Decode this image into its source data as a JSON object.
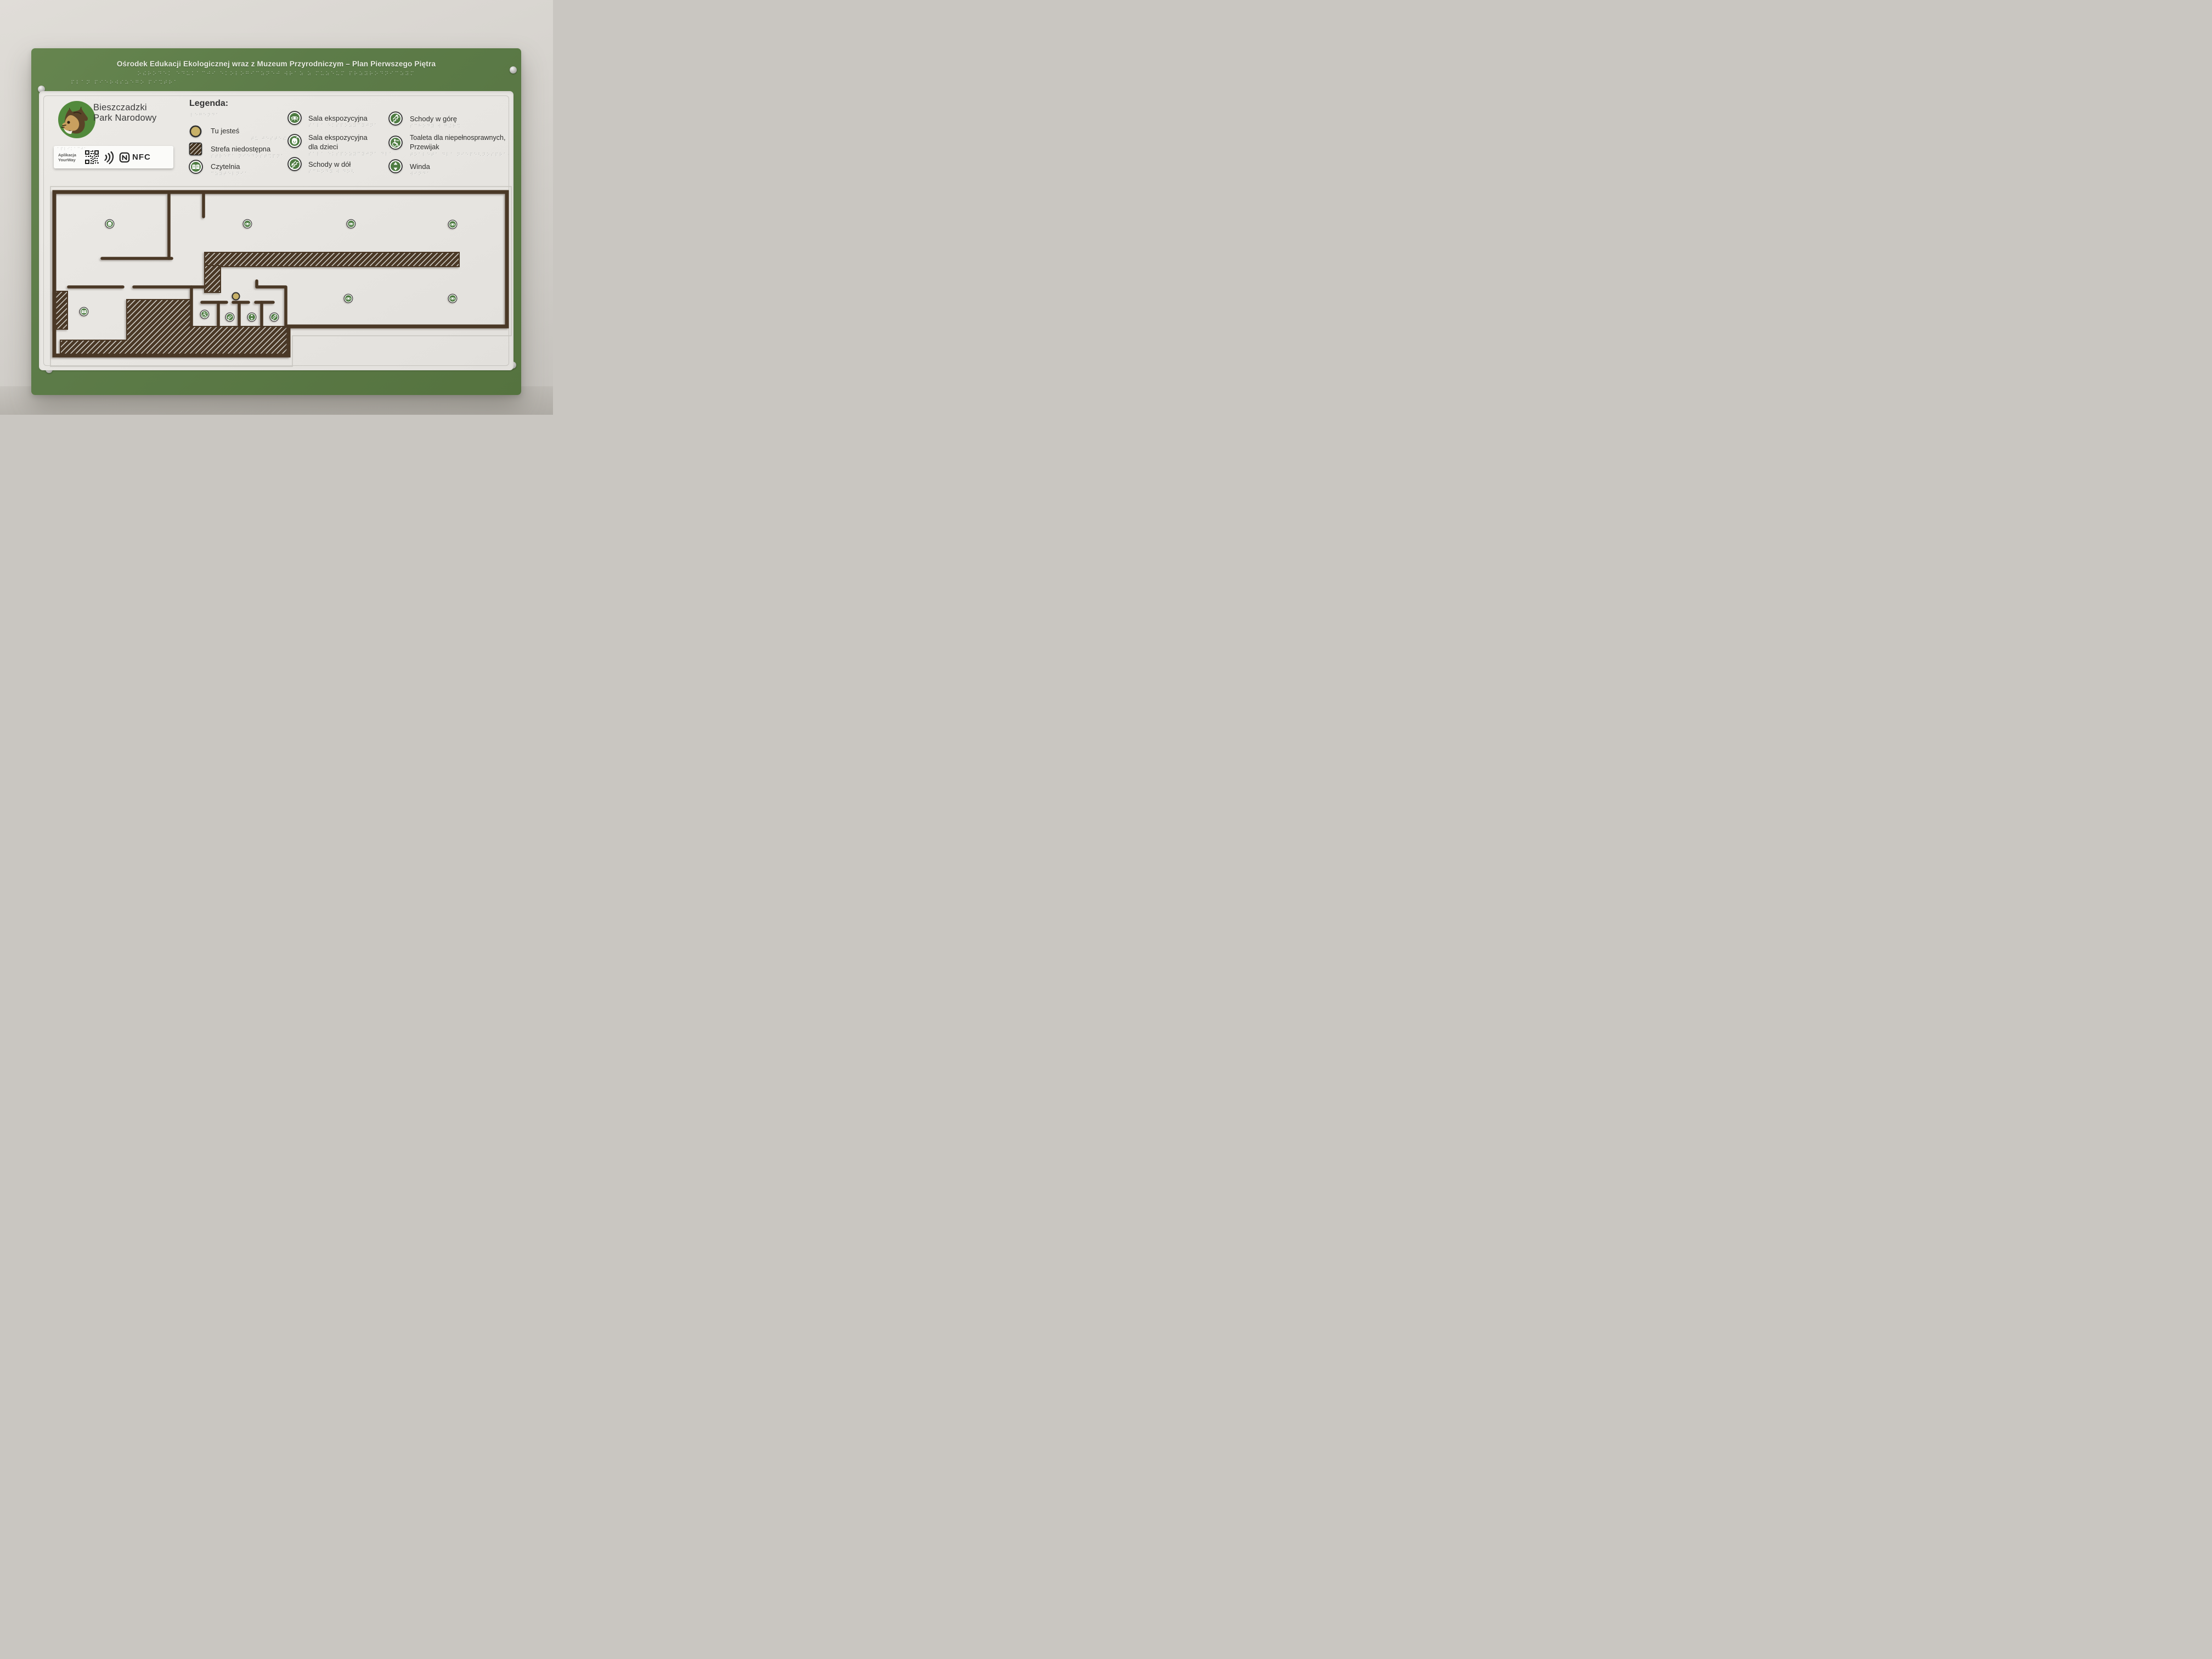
{
  "title": {
    "text": "Ośrodek Edukacji Ekologicznej wraz z Muzeum Przyrodniczym – Plan Pierwszego Piętra"
  },
  "logo": {
    "line1": "Bieszczadzki",
    "line2": "Park Narodowy"
  },
  "app_tag": {
    "line1": "Aplikacja",
    "line2": "YourWay",
    "nfc_label": "NFC"
  },
  "legend": {
    "heading": "Legenda:",
    "items": [
      {
        "icon": "you-are-here-dot",
        "label": "Tu jesteś",
        "label2": "",
        "braille": "⠞⠥ ⠚⠑⠎⠞⠑⠮"
      },
      {
        "icon": "restricted-area-swatch",
        "label": "Strefa niedostępna",
        "label2": "",
        "braille": "⠎⠞⠗⠑⠋⠁ ⠝⠊⠑⠙⠕⠎⠞⠩⠏⠝⠁"
      },
      {
        "icon": "reading-room-icon",
        "label": "Czytelnia",
        "label2": "",
        "braille": "⠉⠵⠽⠞⠑⠇⠝⠊⠁"
      },
      {
        "icon": "exhibition-hall-icon",
        "label": "Sala ekspozycyjna",
        "label2": "",
        "braille": "⠎⠁⠇⠁ ⠑⠅⠎⠏⠕⠵⠽⠉⠽⠚⠝⠁"
      },
      {
        "icon": "children-exhibition-icon",
        "label": "Sala ekspozycyjna",
        "label2": "dla dzieci",
        "braille": "⠎⠁⠇⠁ ⠑⠅⠎⠏⠕⠵⠽⠉⠽⠚⠝⠁ ⠙⠇⠁ ⠙⠵⠊⠑⠉⠊"
      },
      {
        "icon": "stairs-down-icon",
        "label": "Schody w dół",
        "label2": "",
        "braille": "⠎⠉⠓⠕⠙⠽ ⠺ ⠙⠕⠣"
      },
      {
        "icon": "stairs-up-icon",
        "label": "Schody w górę",
        "label2": "",
        "braille": "⠎⠉⠓⠕⠙⠽ ⠺ ⠛⠬⠗⠩"
      },
      {
        "icon": "accessible-toilet-icon",
        "label": "Toaleta dla niepełnosprawnych,",
        "label2": "Przewijak",
        "braille": "⠞⠕⠁⠇⠑⠞⠁ ⠙⠇⠁ ⠝⠊⠑⠏⠑⠣⠝⠕⠎⠏⠗⠁⠺⠝⠽⠉⠓ ⠏⠗⠵⠑⠺⠊⠚⠁⠅"
      },
      {
        "icon": "elevator-icon",
        "label": "Winda",
        "label2": "",
        "braille": "⠺⠊⠝⠙⠁"
      }
    ]
  },
  "braille": {
    "title_row1": "⠕⠮⠗⠕⠙⠑⠅ ⠑⠙⠥⠅⠁⠉⠚⠊ ⠑⠅⠕⠇⠕⠛⠊⠉⠵⠝⠑⠚ ⠺⠗⠁⠵ ⠵ ⠍⠥⠵⠑⠥⠍ ⠏⠗⠵⠽⠗⠕⠙⠝⠊⠉⠵⠽⠍",
    "title_row2": "⠏⠇⠁⠝ ⠏⠊⠑⠗⠺⠎⠵⠑⠛⠕ ⠏⠊⠩⠞⠗⠁",
    "legenda": "⠇⠑⠛⠑⠝⠙⠁",
    "app": "⠁⠏⠇⠊⠅⠁⠉⠚⠁"
  },
  "plan": {
    "markers": [
      {
        "icon": "child",
        "meaning": "Sala ekspozycyjna dla dzieci"
      },
      {
        "icon": "eye",
        "meaning": "Sala ekspozycyjna"
      },
      {
        "icon": "eye",
        "meaning": "Sala ekspozycyjna"
      },
      {
        "icon": "eye",
        "meaning": "Sala ekspozycyjna"
      },
      {
        "icon": "eye",
        "meaning": "Sala ekspozycyjna"
      },
      {
        "icon": "eye",
        "meaning": "Sala ekspozycyjna"
      },
      {
        "icon": "book",
        "meaning": "Czytelnia"
      },
      {
        "icon": "wc",
        "meaning": "Toaleta dla niepełnosprawnych, Przewijak"
      },
      {
        "icon": "sd",
        "meaning": "Schody w dół"
      },
      {
        "icon": "lift",
        "meaning": "Winda"
      },
      {
        "icon": "su",
        "meaning": "Schody w górę"
      }
    ],
    "you_are_here": {
      "label": "Tu jesteś"
    }
  },
  "colors": {
    "board_green": "#5d7c49",
    "icon_green": "#4e7c42",
    "wall_brown": "#4a3826",
    "you_are_here_gold": "#c8b168",
    "panel_white": "#e8e6e2"
  }
}
